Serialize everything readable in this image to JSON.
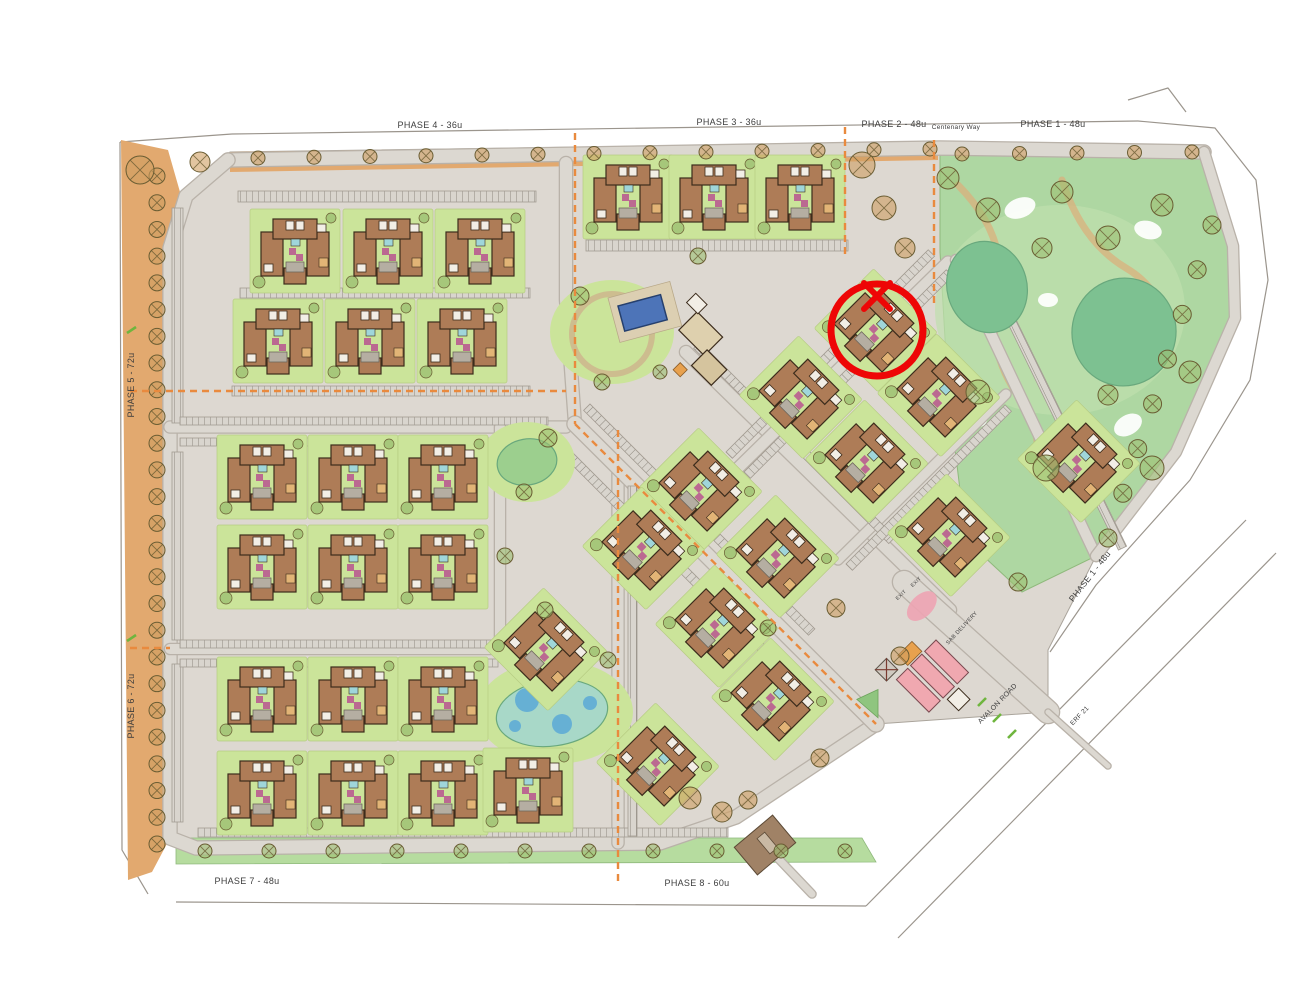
{
  "meta": {
    "title": "Residential development phasing site plan",
    "canvas": {
      "w": 1298,
      "h": 1003
    }
  },
  "colors": {
    "page_bg": "#ffffff",
    "site_base": "#ddd8d1",
    "road_fill": "#dcd8d1",
    "road_casing": "#b9b2a9",
    "band_tan": "#e2a96f",
    "green_plot": "#cbe49a",
    "green_park": "#aed7a2",
    "green_park_inner": "#bfe0ae",
    "green_strip": "#b6dc9f",
    "pond_green": "#7dc191",
    "pond_green2": "#9ccf8e",
    "pond_teal": "#a8d8c8",
    "pond_blue_dot": "#5aa9d6",
    "pool_blue": "#4d74b8",
    "building_fill": "#ae7c57",
    "building_stroke": "#3c2c1c",
    "roof_white": "#f2eee6",
    "magenta": "#b8538f",
    "cyan": "#9fd6da",
    "parking_bg": "#d9d5ce",
    "parking_line": "#8d877e",
    "pink": "#f0a8b0",
    "gate_brown": "#a08266",
    "marker_red": "#ee0606",
    "dash_orange": "#e98a3e",
    "tick_green": "#6fb53e",
    "tree_stroke": "#6a5d33",
    "tree_tan": "#cf9f60",
    "tree_green": "#9cbf72",
    "path_tan": "#d9b07c",
    "outline": "#9b958d",
    "label_color": "#3d3d3d"
  },
  "marker": {
    "description": "red circle with X highlighting one building block",
    "cx": 877,
    "cy": 330,
    "r": 46,
    "stroke_width": 7,
    "x_mark": {
      "cx": 877,
      "cy": 296,
      "half": 13,
      "stroke_width": 6
    }
  },
  "labels": {
    "phases": [
      {
        "text": "PHASE 4 - 36u",
        "x": 430,
        "y": 128,
        "rot": 0,
        "size": 9
      },
      {
        "text": "PHASE 3 - 36u",
        "x": 729,
        "y": 125,
        "rot": 0,
        "size": 9
      },
      {
        "text": "PHASE 2 - 48u",
        "x": 894,
        "y": 127,
        "rot": 0,
        "size": 9
      },
      {
        "text": "PHASE 1 - 48u",
        "x": 1053,
        "y": 127,
        "rot": 0,
        "size": 9
      },
      {
        "text": "PHASE 5 - 72u",
        "x": 134,
        "y": 385,
        "rot": -90,
        "size": 9
      },
      {
        "text": "PHASE 6 - 72u",
        "x": 134,
        "y": 706,
        "rot": -90,
        "size": 9
      },
      {
        "text": "PHASE 7 - 48u",
        "x": 247,
        "y": 884,
        "rot": 0,
        "size": 9
      },
      {
        "text": "PHASE 8 - 60u",
        "x": 697,
        "y": 886,
        "rot": 0,
        "size": 9
      },
      {
        "text": "PHASE 1 - 48u",
        "x": 1092,
        "y": 578,
        "rot": -52,
        "size": 8.5
      }
    ],
    "roads": [
      {
        "text": "Centenary Way",
        "x": 956,
        "y": 129,
        "rot": 0,
        "size": 6.5
      },
      {
        "text": "AVALON ROAD",
        "x": 999,
        "y": 705,
        "rot": -46,
        "size": 7
      },
      {
        "text": "ERF 21",
        "x": 1081,
        "y": 717,
        "rot": -46,
        "size": 6.5
      },
      {
        "text": "SAB DELIVERY",
        "x": 963,
        "y": 629,
        "rot": -47,
        "size": 5.5
      },
      {
        "text": "EXIT",
        "x": 902,
        "y": 596,
        "rot": -43,
        "size": 5
      },
      {
        "text": "EXIT",
        "x": 917,
        "y": 583,
        "rot": -43,
        "size": 5
      }
    ]
  },
  "map": {
    "site_polygon": [
      [
        230,
        152
      ],
      [
        940,
        142
      ],
      [
        1204,
        152
      ],
      [
        1233,
        240
      ],
      [
        1236,
        318
      ],
      [
        1178,
        452
      ],
      [
        1096,
        556
      ],
      [
        1048,
        650
      ],
      [
        1048,
        712
      ],
      [
        876,
        724
      ],
      [
        736,
        817
      ],
      [
        660,
        843
      ],
      [
        196,
        848
      ],
      [
        170,
        838
      ],
      [
        170,
        248
      ],
      [
        186,
        196
      ]
    ],
    "left_band": [
      [
        121,
        140
      ],
      [
        168,
        150
      ],
      [
        180,
        192
      ],
      [
        170,
        250
      ],
      [
        170,
        838
      ],
      [
        152,
        872
      ],
      [
        128,
        880
      ]
    ],
    "top_band": [
      [
        230,
        152
      ],
      [
        938,
        142
      ],
      [
        938,
        160
      ],
      [
        230,
        172
      ]
    ],
    "topright_band": [
      [
        940,
        142
      ],
      [
        1202,
        150
      ],
      [
        1200,
        168
      ],
      [
        940,
        160
      ]
    ],
    "bottom_strip": [
      [
        176,
        838
      ],
      [
        862,
        838
      ],
      [
        876,
        862
      ],
      [
        176,
        864
      ]
    ],
    "park_polygon": [
      [
        940,
        152
      ],
      [
        1205,
        155
      ],
      [
        1233,
        240
      ],
      [
        1236,
        318
      ],
      [
        1178,
        452
      ],
      [
        1096,
        556
      ],
      [
        1022,
        592
      ],
      [
        966,
        540
      ],
      [
        948,
        390
      ],
      [
        940,
        252
      ]
    ],
    "park_inner": {
      "cx": 1060,
      "cy": 310,
      "rx": 125,
      "ry": 105
    },
    "park_paths": [
      "M958,185 Q1012,240 996,300 Q986,352 1022,402 Q1046,436 1032,470",
      "M1062,180 Q1082,242 1126,268 Q1160,288 1170,330"
    ],
    "play_areas": [
      [
        1020,
        208,
        16,
        10,
        -20
      ],
      [
        1148,
        230,
        14,
        9,
        15
      ],
      [
        1128,
        425,
        15,
        10,
        -30
      ],
      [
        975,
        420,
        12,
        8,
        0
      ],
      [
        1048,
        300,
        10,
        7,
        0
      ]
    ],
    "ponds": [
      {
        "cx": 987,
        "cy": 287,
        "rx": 40,
        "ry": 46,
        "rot": -15,
        "fill": "pond_green"
      },
      {
        "cx": 1124,
        "cy": 332,
        "rx": 52,
        "ry": 54,
        "rot": 10,
        "fill": "pond_green"
      },
      {
        "cx": 527,
        "cy": 462,
        "rx": 30,
        "ry": 23,
        "rot": -10,
        "fill": "pond_green2"
      },
      {
        "cx": 552,
        "cy": 713,
        "rx": 56,
        "ry": 33,
        "rot": -8,
        "fill": "pond_teal"
      }
    ],
    "pond_gardens": [
      {
        "cx": 527,
        "cy": 462,
        "rx": 48,
        "ry": 40
      },
      {
        "cx": 555,
        "cy": 712,
        "rx": 78,
        "ry": 52
      }
    ],
    "pond_blue_dots": [
      [
        527,
        700,
        12
      ],
      [
        562,
        724,
        10
      ],
      [
        590,
        703,
        7
      ],
      [
        515,
        726,
        6
      ]
    ],
    "roads": [
      {
        "pts": [
          [
            228,
            160
          ],
          [
            940,
            148
          ],
          [
            1204,
            152
          ]
        ],
        "w": 13
      },
      {
        "pts": [
          [
            228,
            160
          ],
          [
            186,
            196
          ],
          [
            170,
            248
          ],
          [
            170,
            838
          ],
          [
            196,
            848
          ],
          [
            660,
            843
          ],
          [
            736,
            817
          ],
          [
            876,
            724
          ]
        ],
        "w": 13
      },
      {
        "pts": [
          [
            566,
            163
          ],
          [
            566,
            300
          ],
          [
            575,
            424
          ]
        ],
        "w": 12
      },
      {
        "pts": [
          [
            170,
            427
          ],
          [
            566,
            427
          ]
        ],
        "w": 11
      },
      {
        "pts": [
          [
            170,
            649
          ],
          [
            505,
            649
          ]
        ],
        "w": 10
      },
      {
        "pts": [
          [
            500,
            427
          ],
          [
            500,
            650
          ]
        ],
        "w": 10
      },
      {
        "pts": [
          [
            618,
            468
          ],
          [
            618,
            843
          ]
        ],
        "w": 11
      },
      {
        "pts": [
          [
            575,
            424
          ],
          [
            876,
            724
          ]
        ],
        "w": 15
      },
      {
        "pts": [
          [
            686,
            352
          ],
          [
            950,
            610
          ]
        ],
        "w": 12
      },
      {
        "pts": [
          [
            738,
            468
          ],
          [
            948,
            262
          ]
        ],
        "w": 11
      },
      {
        "pts": [
          [
            838,
            560
          ],
          [
            1006,
            394
          ]
        ],
        "w": 9
      },
      {
        "pts": [
          [
            956,
            260
          ],
          [
            1096,
            556
          ]
        ],
        "w": 10
      },
      {
        "pts": [
          [
            1204,
            152
          ],
          [
            1233,
            246
          ],
          [
            1235,
            318
          ],
          [
            1176,
            452
          ],
          [
            1096,
            556
          ]
        ],
        "w": 10
      },
      {
        "pts": [
          [
            904,
            582
          ],
          [
            1048,
            712
          ]
        ],
        "w": 22
      },
      {
        "pts": [
          [
            1048,
            712
          ],
          [
            1108,
            766
          ]
        ],
        "w": 5
      },
      {
        "pts": [
          [
            772,
            852
          ],
          [
            812,
            894
          ]
        ],
        "w": 7
      }
    ],
    "parking_strips": [
      [
        238,
        191,
        298,
        11,
        0
      ],
      [
        240,
        288,
        290,
        10,
        0
      ],
      [
        232,
        386,
        298,
        10,
        0
      ],
      [
        172,
        208,
        11,
        215,
        0
      ],
      [
        172,
        452,
        11,
        188,
        0
      ],
      [
        172,
        664,
        11,
        158,
        0
      ],
      [
        586,
        240,
        262,
        11,
        0
      ],
      [
        180,
        417,
        368,
        8,
        0
      ],
      [
        180,
        438,
        368,
        8,
        0
      ],
      [
        180,
        640,
        318,
        8,
        0
      ],
      [
        180,
        659,
        318,
        8,
        0
      ],
      [
        198,
        828,
        530,
        9,
        0
      ],
      [
        628,
        486,
        9,
        350,
        0
      ],
      [
        590,
        404,
        318,
        9,
        45
      ],
      [
        566,
        446,
        318,
        9,
        45
      ],
      [
        700,
        342,
        276,
        9,
        45
      ],
      [
        744,
        472,
        286,
        9,
        -45
      ],
      [
        726,
        452,
        286,
        9,
        -45
      ],
      [
        976,
        258,
        9,
        325,
        -26
      ],
      [
        846,
        564,
        225,
        9,
        -45
      ]
    ],
    "blocks_rot0": [
      [
        295,
        252
      ],
      [
        388,
        252
      ],
      [
        480,
        252
      ],
      [
        278,
        342
      ],
      [
        370,
        342
      ],
      [
        462,
        342
      ],
      [
        628,
        198
      ],
      [
        714,
        198
      ],
      [
        800,
        198
      ],
      [
        262,
        478
      ],
      [
        353,
        478
      ],
      [
        443,
        478
      ],
      [
        262,
        568
      ],
      [
        353,
        568
      ],
      [
        443,
        568
      ],
      [
        262,
        700
      ],
      [
        353,
        700
      ],
      [
        443,
        700
      ],
      [
        262,
        794
      ],
      [
        353,
        794
      ],
      [
        443,
        794
      ],
      [
        528,
        791
      ]
    ],
    "blocks_rot45": [
      [
        545,
        650
      ],
      [
        700,
        490
      ],
      [
        643,
        549
      ],
      [
        777,
        557
      ],
      [
        716,
        627
      ],
      [
        772,
        700
      ],
      [
        657,
        765
      ],
      [
        800,
        398
      ],
      [
        875,
        331
      ],
      [
        938,
        396
      ],
      [
        866,
        462
      ],
      [
        948,
        536
      ],
      [
        1078,
        462
      ]
    ],
    "pool": {
      "garden": {
        "cx": 612,
        "cy": 332,
        "rx": 62,
        "ry": 52
      },
      "ring": {
        "cx": 612,
        "cy": 334,
        "r": 40
      },
      "deck": [
        608,
        298,
        64,
        46,
        -15
      ],
      "water": [
        618,
        306,
        44,
        26,
        -15
      ]
    },
    "clubhouse": {
      "x": 700,
      "y": 340,
      "rot": 45
    },
    "entrance": {
      "x": 936,
      "y": 640,
      "rot": 45
    },
    "gate_bottom": {
      "x": 765,
      "y": 845,
      "rot": 50
    },
    "dashed_lines": [
      [
        [
          575,
          133
        ],
        [
          575,
          424
        ]
      ],
      [
        [
          130,
          391
        ],
        [
          566,
          391
        ]
      ],
      [
        [
          618,
          430
        ],
        [
          618,
          886
        ]
      ],
      [
        [
          845,
          127
        ],
        [
          845,
          258
        ]
      ],
      [
        [
          934,
          140
        ],
        [
          934,
          306
        ]
      ],
      [
        [
          575,
          424
        ],
        [
          876,
          724
        ]
      ],
      [
        [
          130,
          648
        ],
        [
          170,
          648
        ]
      ]
    ],
    "green_ticks": [
      [
        [
          978,
          706
        ],
        [
          986,
          698
        ]
      ],
      [
        [
          993,
          722
        ],
        [
          1001,
          714
        ]
      ],
      [
        [
          1008,
          738
        ],
        [
          1016,
          730
        ]
      ],
      [
        [
          127,
          333
        ],
        [
          136,
          327
        ]
      ],
      [
        [
          127,
          641
        ],
        [
          136,
          635
        ]
      ]
    ],
    "outer_lines": [
      [
        [
          232,
          134
        ],
        [
          1138,
          121
        ]
      ],
      [
        [
          1138,
          121
        ],
        [
          1215,
          128
        ],
        [
          1256,
          180
        ],
        [
          1268,
          280
        ],
        [
          1250,
          380
        ],
        [
          1190,
          480
        ],
        [
          1096,
          585
        ],
        [
          1050,
          652
        ]
      ],
      [
        [
          120,
          142
        ],
        [
          232,
          134
        ]
      ],
      [
        [
          120,
          142
        ],
        [
          122,
          850
        ],
        [
          148,
          894
        ]
      ],
      [
        [
          176,
          902
        ],
        [
          866,
          906
        ]
      ],
      [
        [
          866,
          906
        ],
        [
          1246,
          520
        ]
      ],
      [
        [
          898,
          938
        ],
        [
          1276,
          553
        ]
      ],
      [
        [
          1128,
          100
        ],
        [
          1168,
          88
        ],
        [
          1186,
          112
        ]
      ]
    ],
    "tree_rows": [
      [
        157,
        176,
        157,
        844,
        26,
        8,
        "t"
      ],
      [
        258,
        158,
        930,
        149,
        56,
        7,
        "t"
      ],
      [
        962,
        154,
        1192,
        152,
        52,
        7,
        "t"
      ],
      [
        205,
        851,
        845,
        851,
        64,
        7,
        "g"
      ],
      [
        1212,
        225,
        1108,
        538,
        46,
        9,
        "g"
      ]
    ],
    "trees": [
      [
        948,
        178,
        11,
        "g"
      ],
      [
        988,
        210,
        12,
        "g"
      ],
      [
        1062,
        192,
        11,
        "g"
      ],
      [
        1108,
        238,
        12,
        "g"
      ],
      [
        1162,
        205,
        11,
        "g"
      ],
      [
        978,
        392,
        12,
        "g"
      ],
      [
        1046,
        468,
        13,
        "g"
      ],
      [
        1152,
        468,
        12,
        "g"
      ],
      [
        1190,
        372,
        11,
        "g"
      ],
      [
        1108,
        395,
        10,
        "g"
      ],
      [
        1042,
        248,
        10,
        "g"
      ],
      [
        862,
        165,
        13,
        "t"
      ],
      [
        884,
        208,
        12,
        "t"
      ],
      [
        905,
        248,
        10,
        "t"
      ],
      [
        140,
        170,
        14,
        "t"
      ],
      [
        200,
        162,
        10,
        "t"
      ],
      [
        690,
        798,
        11,
        "t"
      ],
      [
        722,
        812,
        10,
        "t"
      ],
      [
        748,
        800,
        9,
        "t"
      ],
      [
        698,
        256,
        8,
        "g"
      ],
      [
        580,
        296,
        9,
        "g"
      ],
      [
        548,
        438,
        9,
        "g"
      ],
      [
        524,
        492,
        8,
        "g"
      ],
      [
        602,
        382,
        8,
        "g"
      ],
      [
        660,
        372,
        7,
        "g"
      ],
      [
        545,
        610,
        8,
        "g"
      ],
      [
        505,
        556,
        8,
        "g"
      ],
      [
        820,
        758,
        9,
        "t"
      ],
      [
        608,
        660,
        8,
        "g"
      ],
      [
        836,
        608,
        9,
        "t"
      ],
      [
        900,
        656,
        9,
        "t"
      ],
      [
        1018,
        582,
        9,
        "g"
      ],
      [
        768,
        628,
        8,
        "g"
      ]
    ]
  }
}
